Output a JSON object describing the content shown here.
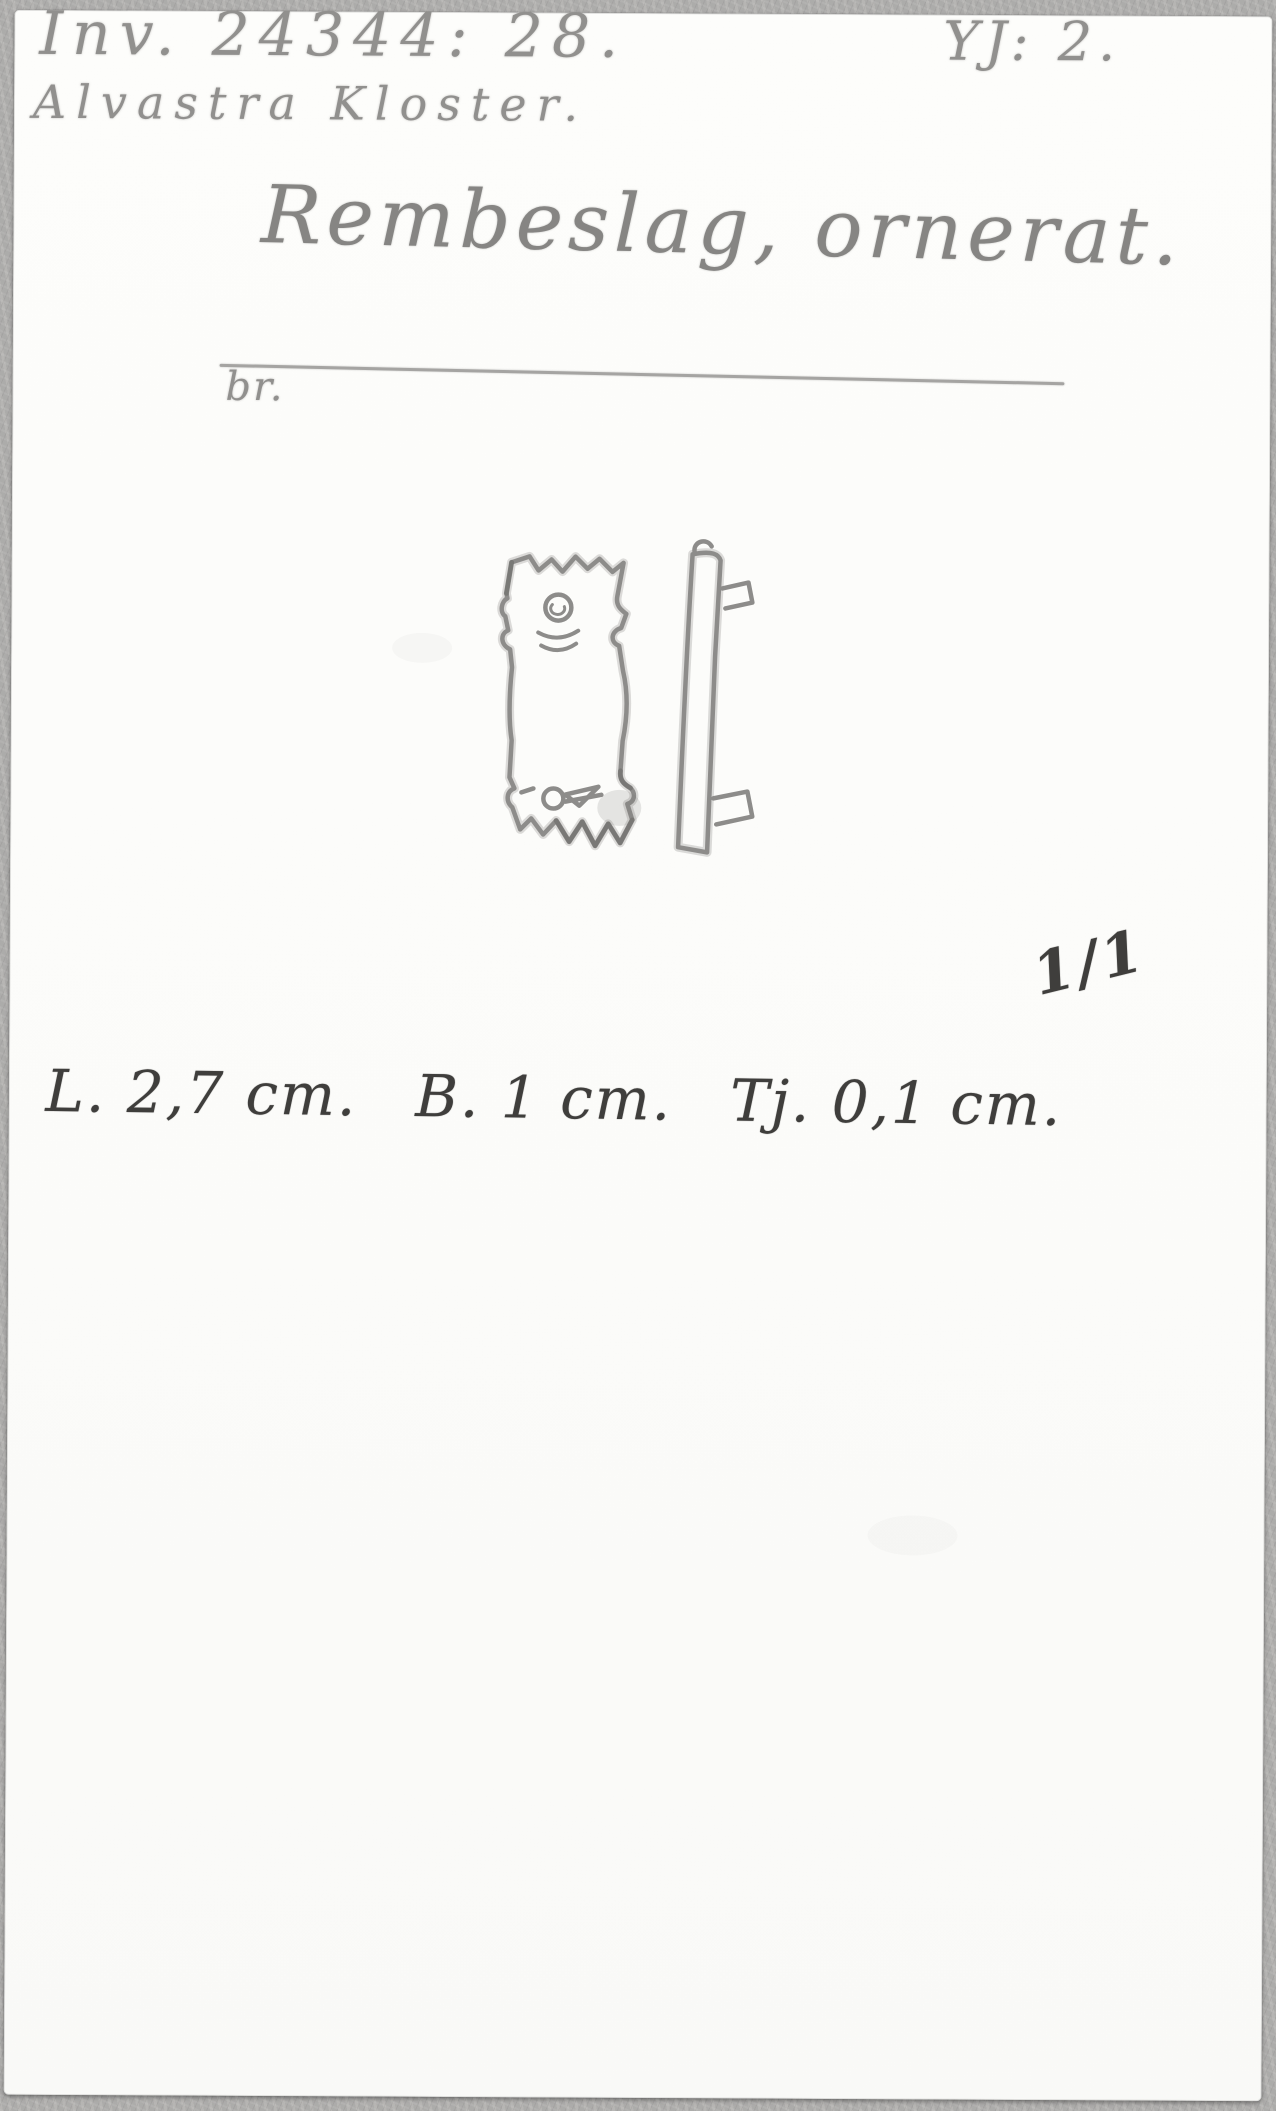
{
  "document": {
    "inventory_no": "Inv. 24344: 28.",
    "plate_ref": "YJ: 2.",
    "provenance": "Alvastra Kloster.",
    "title": "Rembeslag, ornerat.",
    "material": "br.",
    "scale": "1/1",
    "measurements": [
      "L. 2,7 cm.",
      "B. 1 cm.",
      "Tj. 0,1 cm."
    ]
  },
  "sketch": {
    "front_view_icon": "strap-mount-front-view",
    "side_view_icon": "strap-mount-side-profile"
  },
  "colors": {
    "backing_gray": "#b2b1af",
    "card_white": "#fcfcfa",
    "pencil_gray": "#8f8e8c",
    "ink_dark": "#3f3e3c"
  }
}
